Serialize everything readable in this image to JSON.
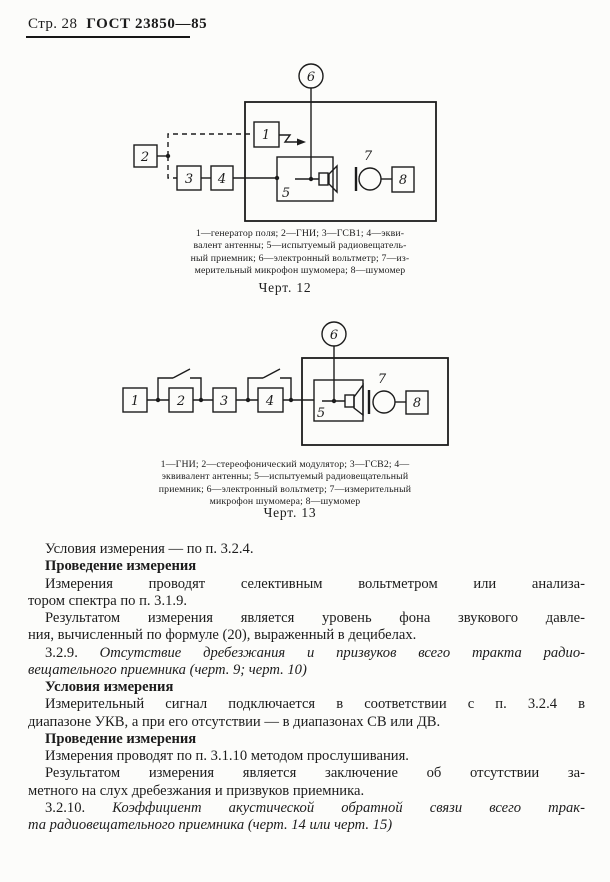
{
  "header": {
    "page_label": "Стр. 28",
    "doc_number": "ГОСТ 23850—85"
  },
  "colors": {
    "ink": "#1c1c1c",
    "paper": "#fcfcfa"
  },
  "fig12": {
    "block_labels": {
      "b1": "1",
      "b2": "2",
      "b3": "3",
      "b4": "4",
      "b5": "5",
      "b6": "6",
      "b7": "7",
      "b8": "8"
    },
    "caption_lines": [
      "1—генератор поля;  2—ГНИ;  3—ГСВ1;  4—экви-",
      "валент антенны;  5—испытуемый радиовещатель-",
      "ный приемник;  6—электронный вольтметр;  7—из-",
      "мерительный микрофон шумомера;  8—шумомер"
    ],
    "title": "Черт. 12"
  },
  "fig13": {
    "block_labels": {
      "b1": "1",
      "b2": "2",
      "b3": "3",
      "b4": "4",
      "b5": "5",
      "b6": "6",
      "b7": "7",
      "b8": "8"
    },
    "caption_lines": [
      "1—ГНИ;  2—стереофонический модулятор;  3—ГСВ2;  4—",
      "эквивалент антенны;  5—испытуемый радиовещательный",
      "приемник;  6—электронный вольтметр;  7—измерительный",
      "микрофон шумомера;  8—шумомер"
    ],
    "title": "Черт. 13"
  },
  "body": {
    "lines": [
      {
        "ind": 1,
        "full": 0,
        "seg": [
          {
            "t": "Условия измерения — по п. 3.2.4.",
            "st": "n"
          }
        ]
      },
      {
        "ind": 1,
        "full": 0,
        "seg": [
          {
            "t": "Проведение измерения",
            "st": "b"
          }
        ]
      },
      {
        "ind": 1,
        "full": 1,
        "seg": [
          {
            "t": "Измерения проводят селективным вольтметром или анализа-",
            "st": "n"
          }
        ]
      },
      {
        "ind": 0,
        "full": 0,
        "seg": [
          {
            "t": "тором спектра по п. 3.1.9.",
            "st": "n"
          }
        ]
      },
      {
        "ind": 1,
        "full": 1,
        "seg": [
          {
            "t": "Результатом измерения является уровень фона звукового давле-",
            "st": "n"
          }
        ]
      },
      {
        "ind": 0,
        "full": 0,
        "seg": [
          {
            "t": "ния, вычисленный по формуле (20), выраженный в децибелах.",
            "st": "n"
          }
        ]
      },
      {
        "ind": 1,
        "full": 1,
        "seg": [
          {
            "t": "3.2.9. ",
            "st": "n"
          },
          {
            "t": "Отсутствие дребезжания и призвуков всего тракта радио-",
            "st": "i"
          }
        ]
      },
      {
        "ind": 0,
        "full": 0,
        "seg": [
          {
            "t": "вещательного приемника (черт. 9; черт. 10)",
            "st": "i"
          }
        ]
      },
      {
        "ind": 1,
        "full": 0,
        "seg": [
          {
            "t": "Условия измерения",
            "st": "b"
          }
        ]
      },
      {
        "ind": 1,
        "full": 1,
        "seg": [
          {
            "t": "Измерительный сигнал подключается в соответствии с п. 3.2.4 в",
            "st": "n"
          }
        ]
      },
      {
        "ind": 0,
        "full": 0,
        "seg": [
          {
            "t": "диапазоне УКВ, а при его отсутствии — в диапазонах СВ или ДВ.",
            "st": "n"
          }
        ]
      },
      {
        "ind": 1,
        "full": 0,
        "seg": [
          {
            "t": "Проведение измерения",
            "st": "b"
          }
        ]
      },
      {
        "ind": 1,
        "full": 0,
        "seg": [
          {
            "t": "Измерения проводят по п. 3.1.10 методом прослушивания.",
            "st": "n"
          }
        ]
      },
      {
        "ind": 1,
        "full": 1,
        "seg": [
          {
            "t": "Результатом измерения является заключение об отсутствии за-",
            "st": "n"
          }
        ]
      },
      {
        "ind": 0,
        "full": 0,
        "seg": [
          {
            "t": "метного на слух дребезжания и призвуков приемника.",
            "st": "n"
          }
        ]
      },
      {
        "ind": 1,
        "full": 1,
        "seg": [
          {
            "t": "3.2.10. ",
            "st": "n"
          },
          {
            "t": "Коэффициент акустической обратной связи всего трак-",
            "st": "i"
          }
        ]
      },
      {
        "ind": 0,
        "full": 0,
        "seg": [
          {
            "t": "та радиовещательного приемника (черт. 14 или черт. 15)",
            "st": "i"
          }
        ]
      }
    ]
  }
}
